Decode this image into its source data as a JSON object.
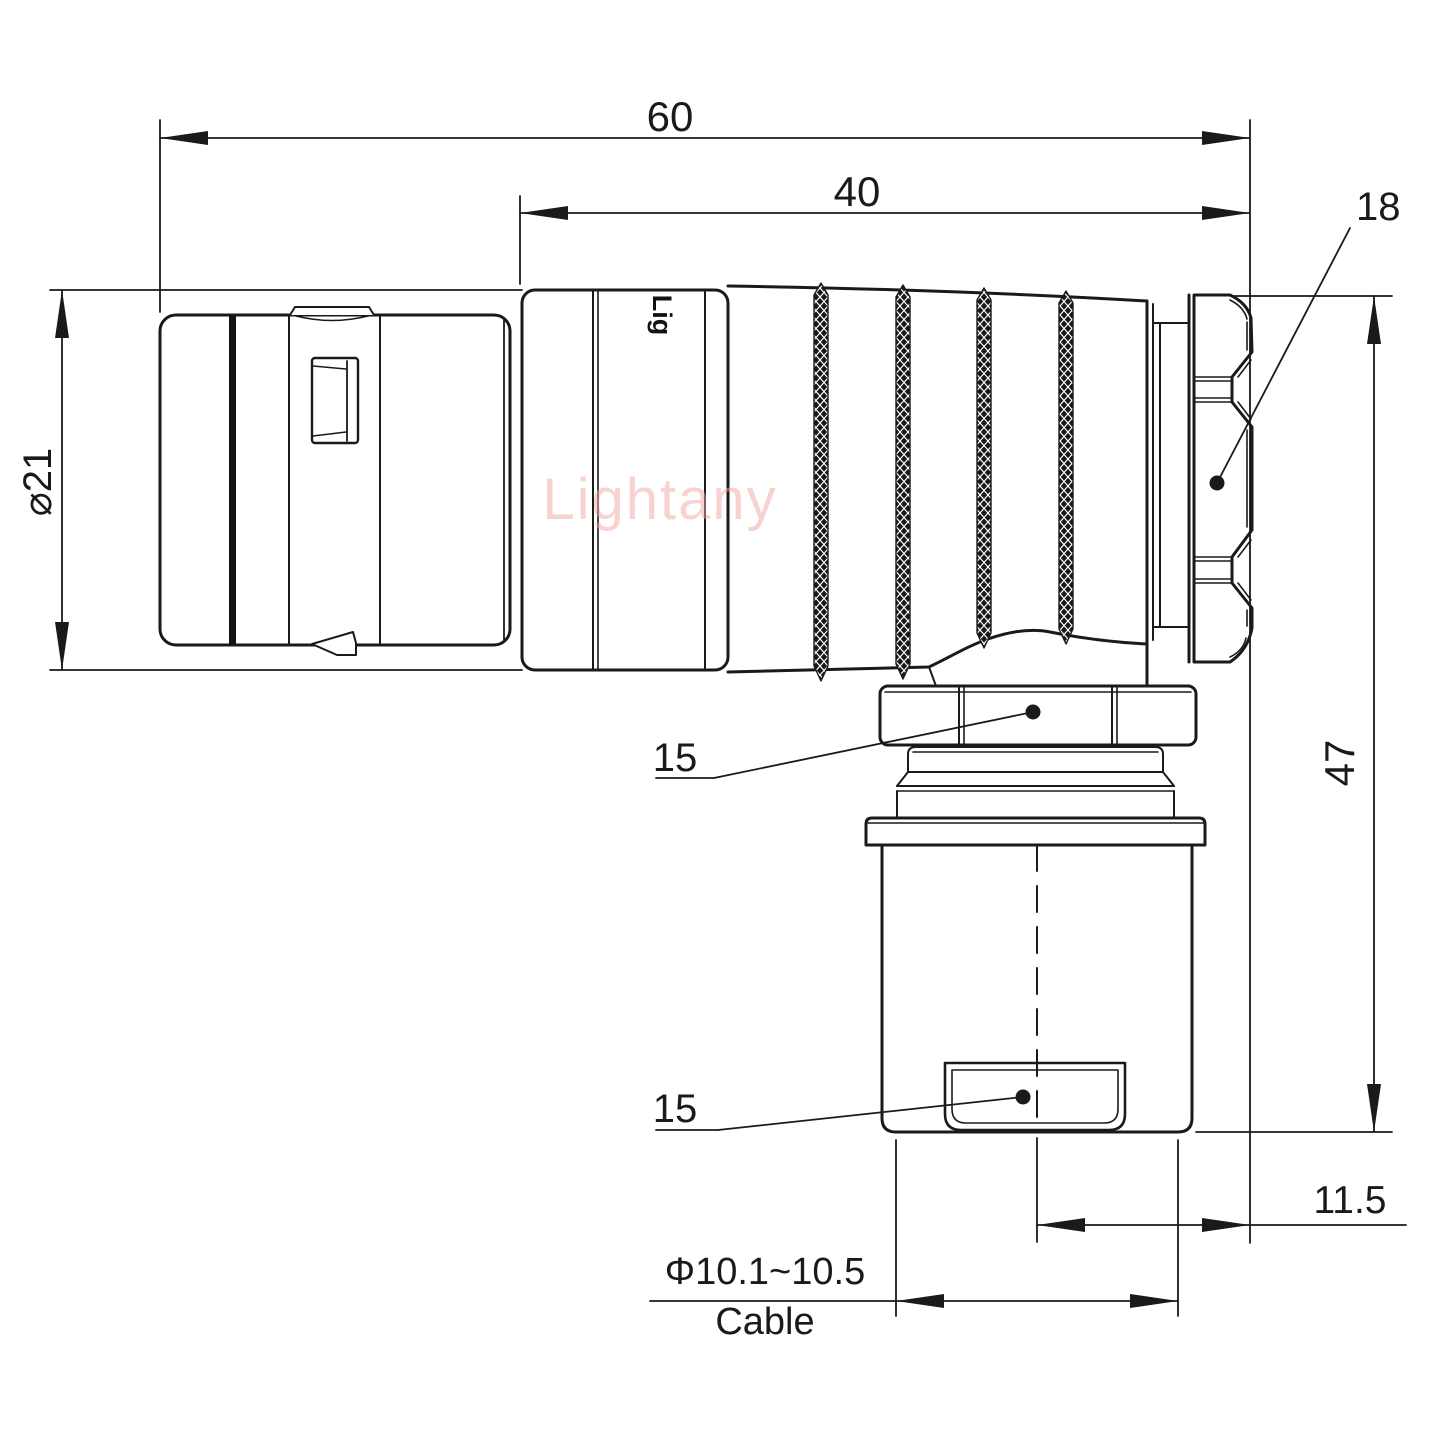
{
  "watermark": {
    "text": "Lightany"
  },
  "body_logo": {
    "text": "Lig"
  },
  "dims": {
    "overall_length": "60",
    "rear_length": "40",
    "nut_across_flats": "18",
    "shell_diameter": "⌀21",
    "total_height": "47",
    "backnut_size": "15",
    "clamp_size": "15",
    "cable_offset": "11.5",
    "cable_diameter_range": "Φ10.1~10.5",
    "cable_word": "Cable"
  },
  "colors": {
    "line": "#1a1a1a",
    "background": "#ffffff",
    "watermark_pink": "#f0a8a3"
  }
}
